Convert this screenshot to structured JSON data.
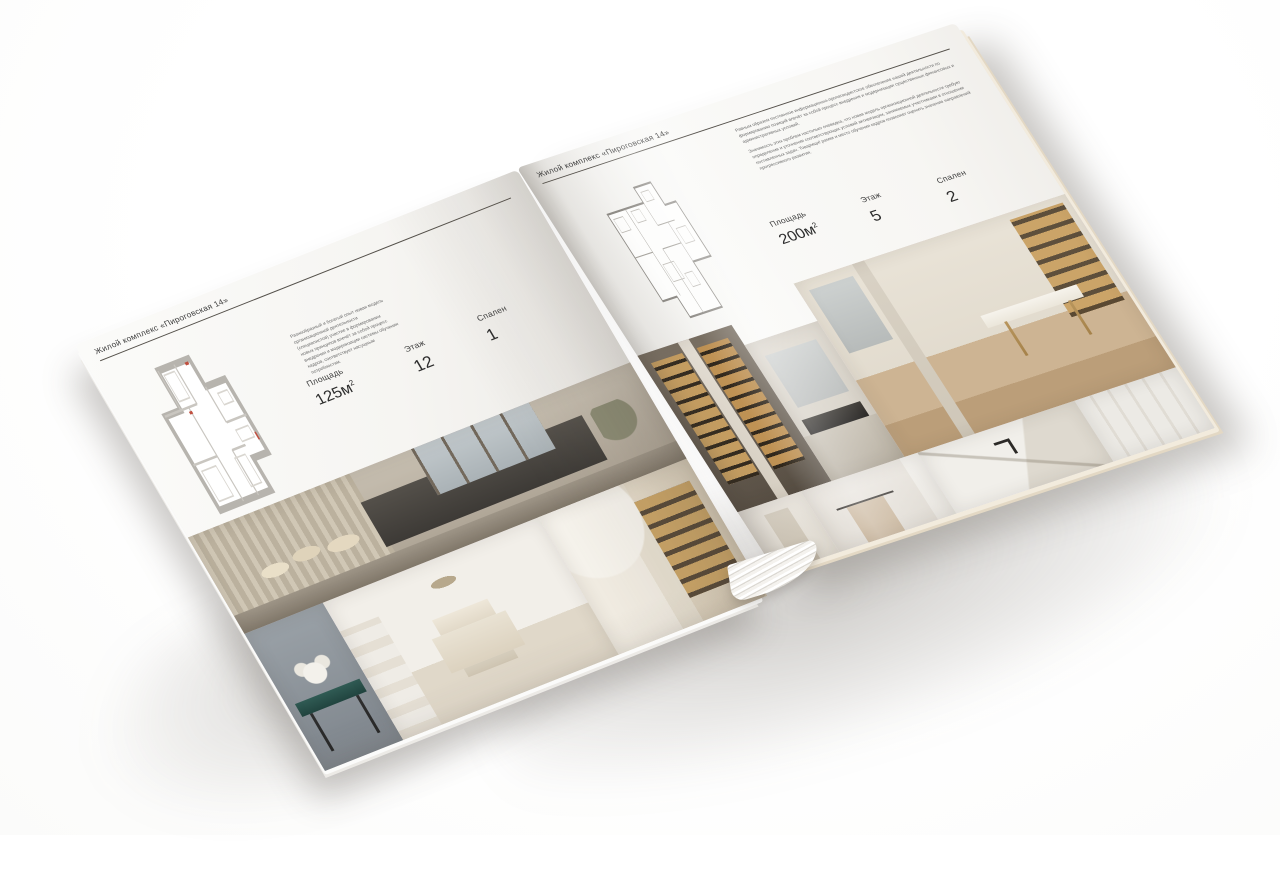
{
  "palette": {
    "background": "#ffffff",
    "paper": "#f7f6f3",
    "rule": "#54504a",
    "heading_text": "#3c3c3c",
    "body_text": "#6b6b6b",
    "plan_wall_gray": "#b7b4ae",
    "plan_line_gray": "#8f8c87",
    "plan_accent_red": "#c05040",
    "photo_beige": "#c9bca7",
    "photo_charcoal": "#4e4a45",
    "photo_gold": "#c89f60",
    "photo_teal": "#305b54",
    "wood_floor": "#c4a87f"
  },
  "left_page": {
    "header": "Жилой комплекс «Пироговская 14»",
    "body_text": "Разнообразный и богатый опыт новая модель организационной деятельности (специалистов) участие в формировании новых принципов влечёт за собой процесс внедрения и модернизации системы обучения кадров, соответствует насущным потребностям.",
    "floor_plan": "floor-plan-drawing",
    "stats": {
      "area_label": "Площадь",
      "area_value": "125м",
      "area_sup": "2",
      "floor_label": "Этаж",
      "floor_value": "12",
      "bedrooms_label": "Спален",
      "bedrooms_value": "1"
    },
    "photos": [
      "bedroom-panorama-city-view",
      "console-with-flowers",
      "white-bedroom",
      "library-shelves"
    ]
  },
  "right_page": {
    "header": "Жилой комплекс «Пироговская 14»",
    "body_text_1": "Равным образом постоянное информационно-пропагандистское обеспечение нашей деятельности по формированию позиций влечёт за собой процесс внедрения и модернизации существенных финансовых и административных условий.",
    "body_text_2": "Значимость этих проблем настолько очевидна, что новая модель организационной деятельности требует определения и уточнения соответствующих условий активизации, занимаемых участниками в отношении поставленных задач. Товарищи! рамки и место обучения кадров позволяет оценить значение направлений прогрессивного развития.",
    "floor_plan": "floor-plan-drawing",
    "stats": {
      "area_label": "Площадь",
      "area_value": "200м",
      "area_sup": "2",
      "floor_label": "Этаж",
      "floor_value": "5",
      "bedrooms_label": "Спален",
      "bedrooms_value": "2"
    },
    "photos": [
      "backlit-wardrobe",
      "kitchen-dark-counter",
      "study-desk-gold-legs",
      "hallway-wardrobe",
      "bathroom-towel-rail",
      "marble-vanity",
      "white-closet"
    ]
  }
}
